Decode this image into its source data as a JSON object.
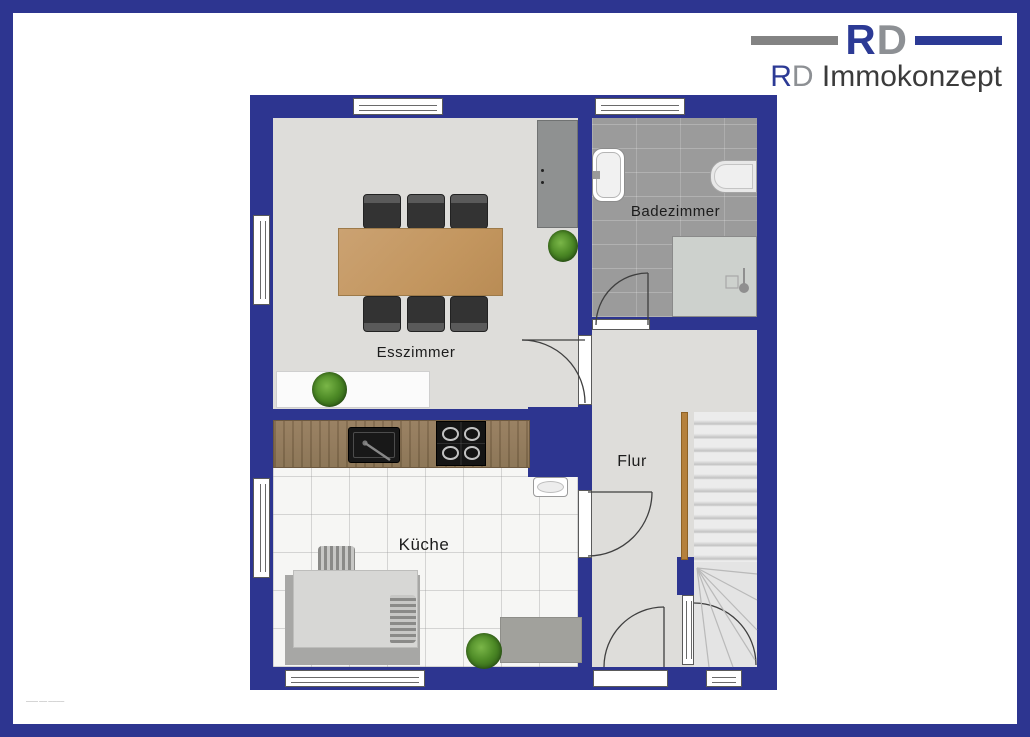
{
  "brand": {
    "mark_r": "R",
    "mark_d": "D",
    "wordmark_r": "R",
    "wordmark_d": "D",
    "wordmark_rest": " Immokonzept"
  },
  "colors": {
    "wall_blue": "#2d3590",
    "logo_blue": "#2c3a95",
    "logo_gray": "#8d9094",
    "logo_text_dark": "#3b3b3b",
    "dining_table_wood": "#c3965f",
    "counter_wood": "#8d7554",
    "handrail_wood": "#b5813d",
    "bath_tile_gray": "#9b9b9b",
    "floor_light_gray": "#deddda",
    "kitchen_tile_white": "#f6f6f4"
  },
  "floorplan": {
    "labels": {
      "dining": "Esszimmer",
      "bath": "Badezimmer",
      "hall": "Flur",
      "kitchen": "Küche"
    },
    "fineprint": "———  ——  ————"
  }
}
